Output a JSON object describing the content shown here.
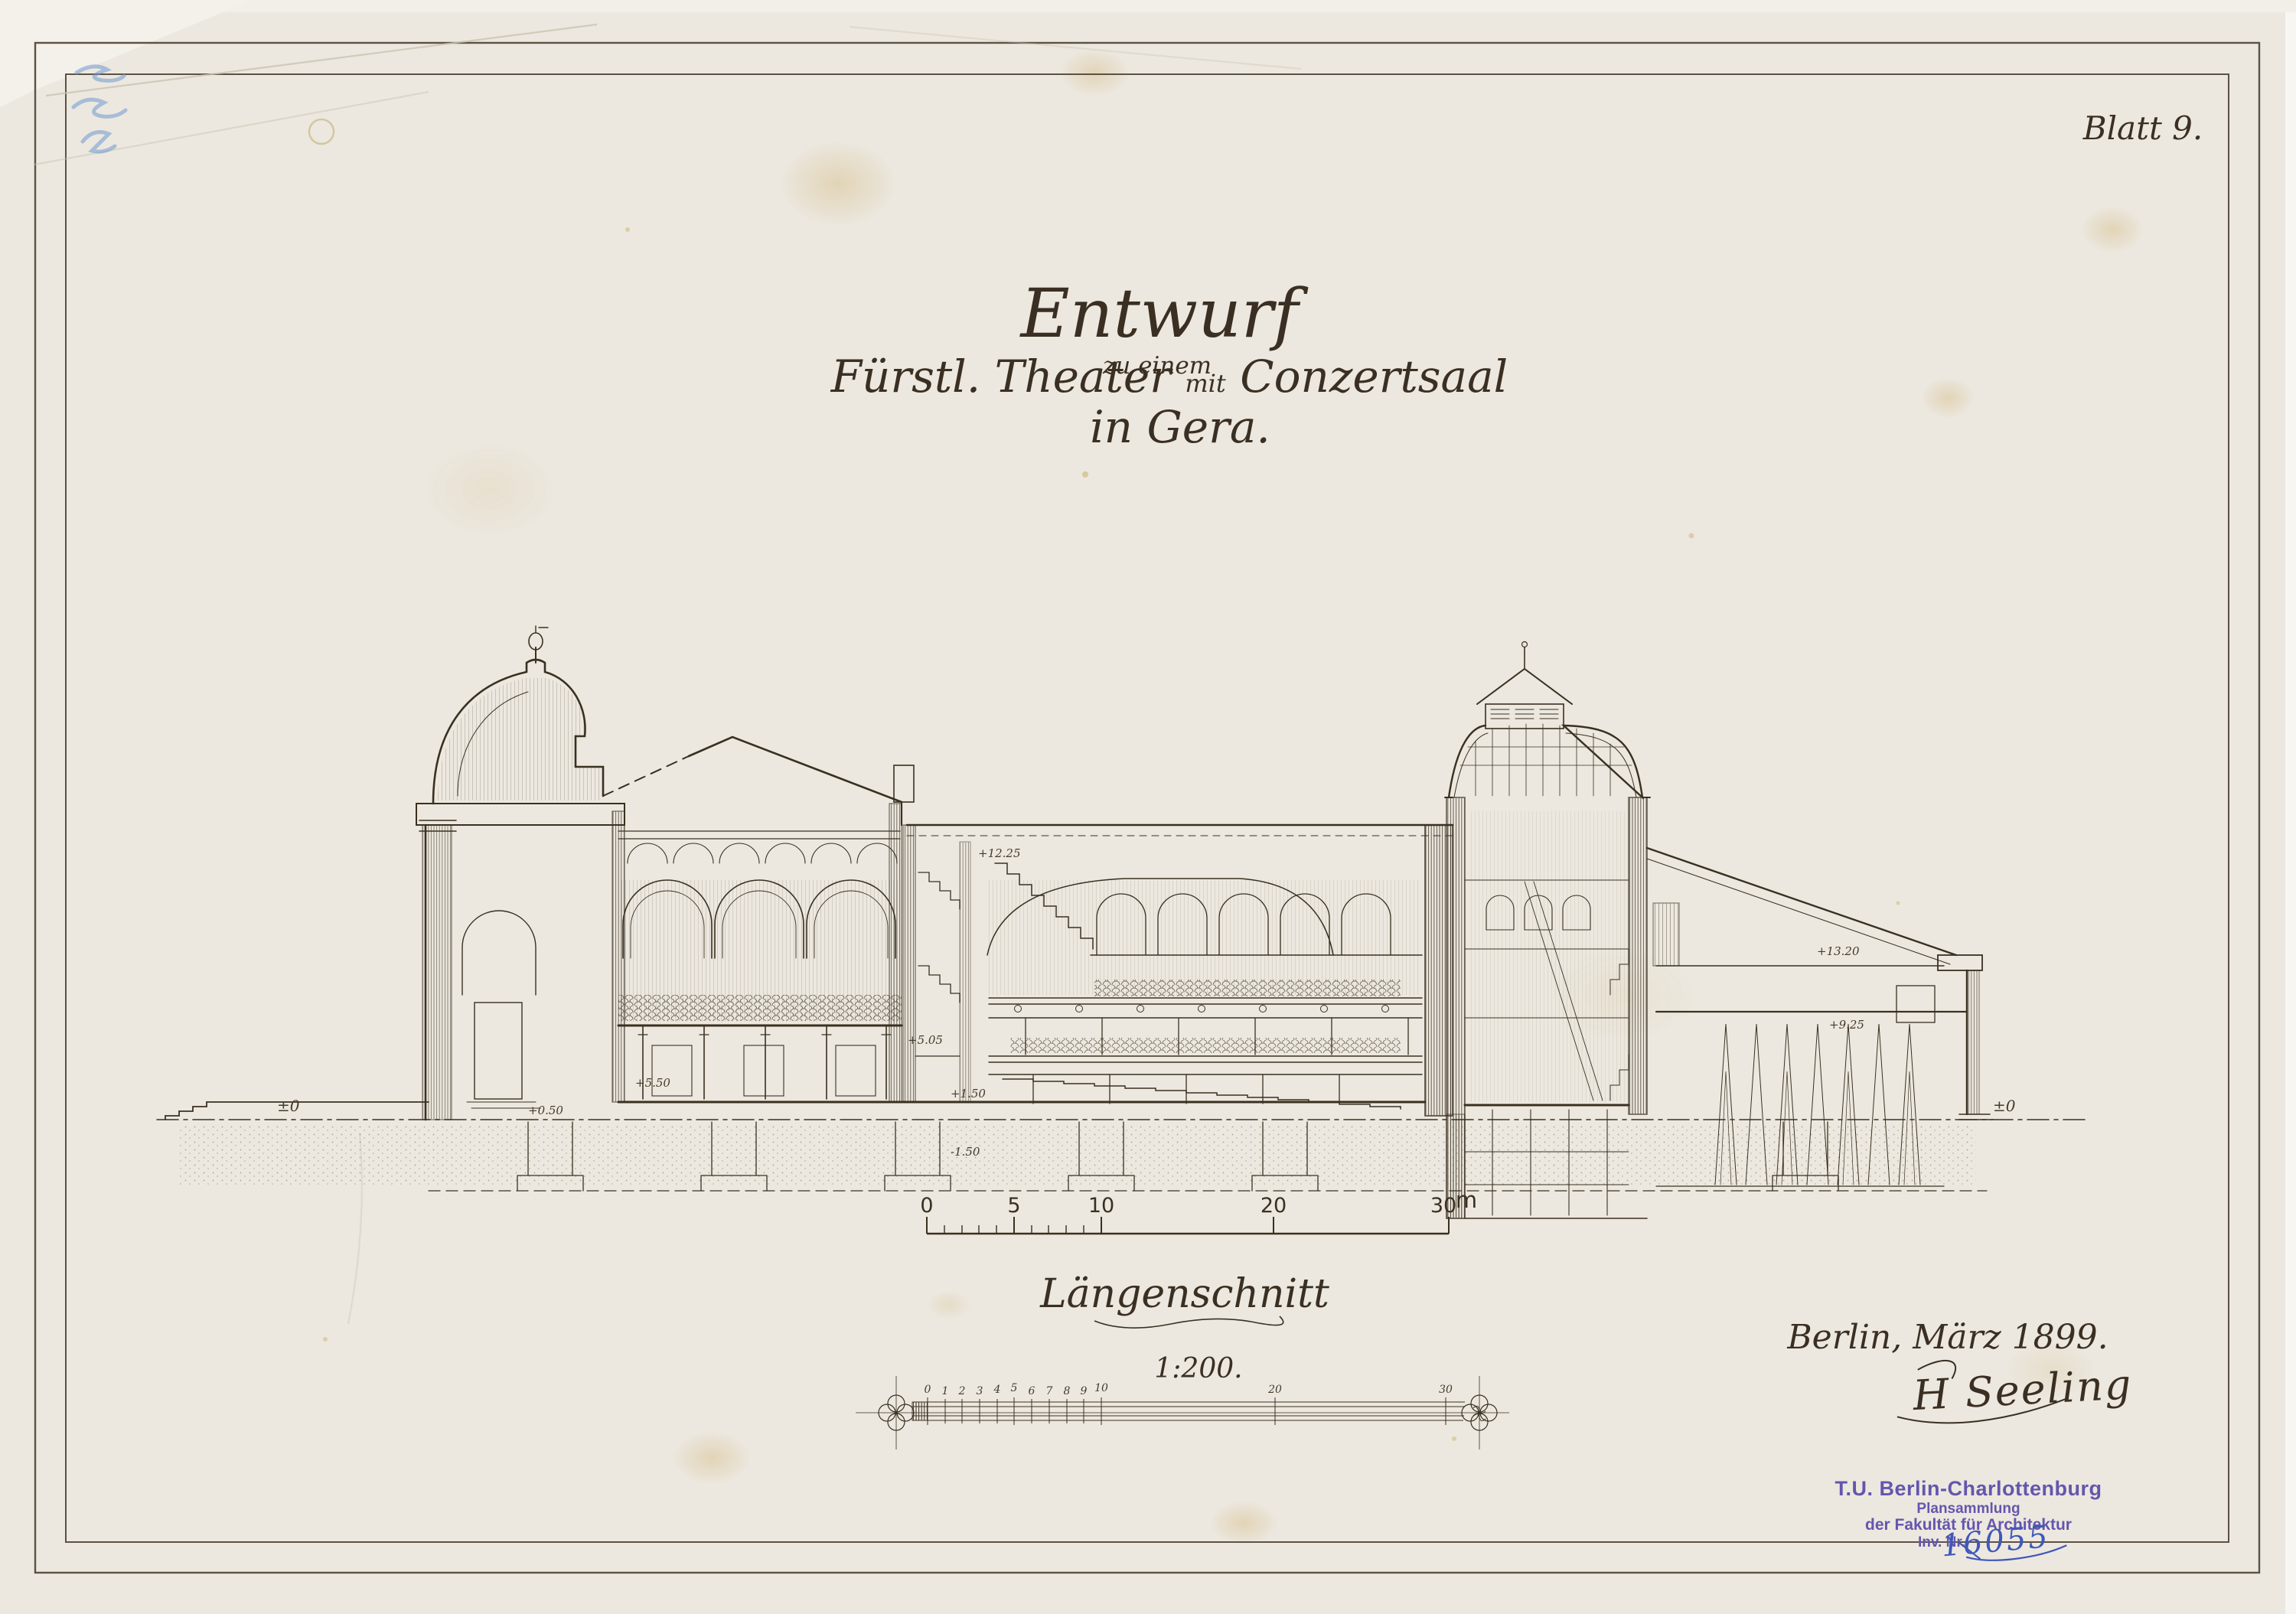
{
  "sheet": {
    "sheet_no": "Blatt 9.",
    "title": {
      "line1": "Entwurf",
      "line2": "zu einem",
      "line3_a": "Fürstl. Theater",
      "line3_mit": "mit",
      "line3_b": "Conzertsaal",
      "line4": "in Gera."
    },
    "caption": {
      "drawing_name": "Längenschnitt",
      "scale": "1:200."
    },
    "place_date": "Berlin, März 1899.",
    "signature": "H Seeling"
  },
  "scale_bar": {
    "unit": "m",
    "labels": [
      "0",
      "5",
      "10",
      "20",
      "30"
    ]
  },
  "ruler": {
    "labels": [
      "0",
      "1",
      "2",
      "3",
      "4",
      "5",
      "6",
      "7",
      "8",
      "9",
      "10",
      "20",
      "30"
    ]
  },
  "levels": {
    "ground_left": "±0",
    "ground_right": "±0",
    "plus050": "+0.50",
    "plus150": "+1.50",
    "minus150": "-1.50",
    "plus505": "+5.05",
    "plus550": "+5.50",
    "plus1225": "+12.25",
    "plus1320": "+13.20",
    "plus925": "+9.25"
  },
  "stamp": {
    "line1": "T.U. Berlin-Charlottenburg",
    "line2": "Plansammlung",
    "line3": "der Fakultät für Architektur",
    "line4": "Inv. Nr.",
    "inv_no": "16055"
  },
  "colors": {
    "paper": "#ece8df",
    "ink": "#3a3020",
    "stamp_purple": "#6456ae",
    "pen_blue": "#3f58b8",
    "pencil_blue": "#6f97cf"
  }
}
